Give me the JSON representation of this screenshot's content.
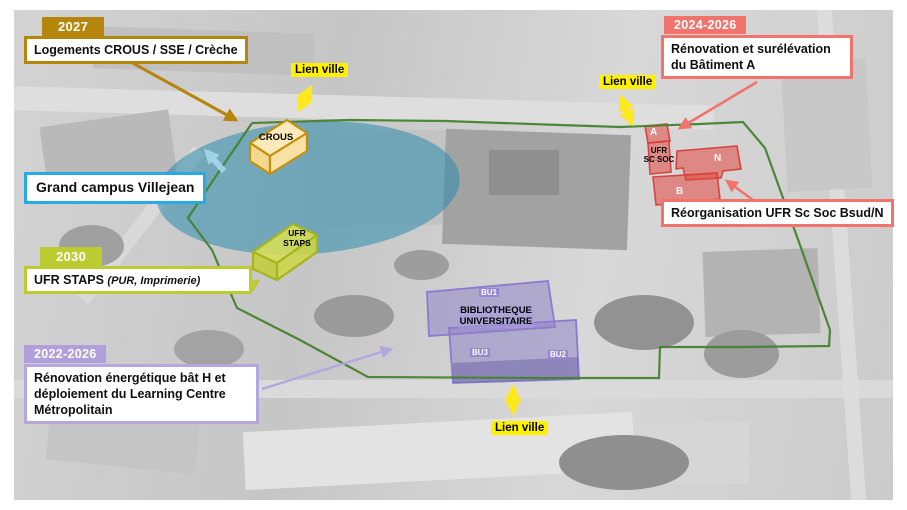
{
  "annotations": {
    "crous": {
      "year": "2027",
      "label": "Logements CROUS / SSE / Crèche"
    },
    "campus": {
      "label": "Grand campus Villejean"
    },
    "staps": {
      "year": "2030",
      "label": "UFR STAPS",
      "detail": "(PUR, Imprimerie)"
    },
    "learning": {
      "year": "2022-2026",
      "label": "Rénovation énergétique bât H et déploiement du Learning Centre Métropolitain"
    },
    "batiment_a": {
      "year": "2024-2026",
      "label": "Rénovation et surélévation du Bâtiment A"
    },
    "sc_soc": {
      "label": "Réorganisation UFR Sc Soc Bsud/N"
    }
  },
  "lien_ville": {
    "label": "Lien ville"
  },
  "buildings": {
    "crous": {
      "label": "CROUS"
    },
    "staps": {
      "line1": "UFR",
      "line2": "STAPS"
    },
    "ufr_sc_soc": {
      "line1": "UFR",
      "line2": "SC SOC",
      "a": "A",
      "n": "N",
      "b": "B"
    },
    "library": {
      "line1": "BIBLIOTHEQUE",
      "line2": "UNIVERSITAIRE",
      "bu1": "BU1",
      "bu2": "BU2",
      "bu3": "BU3"
    }
  },
  "colors": {
    "gold": "#B5860B",
    "campus_blue": "#29ABE2",
    "green_yellow": "#BCCB2F",
    "purple": "#B5A6DF",
    "red": "#F2736C",
    "yellow": "#FFE81C",
    "boundary_green": "#45822F",
    "overlay_blue": "#2A8CAF"
  }
}
